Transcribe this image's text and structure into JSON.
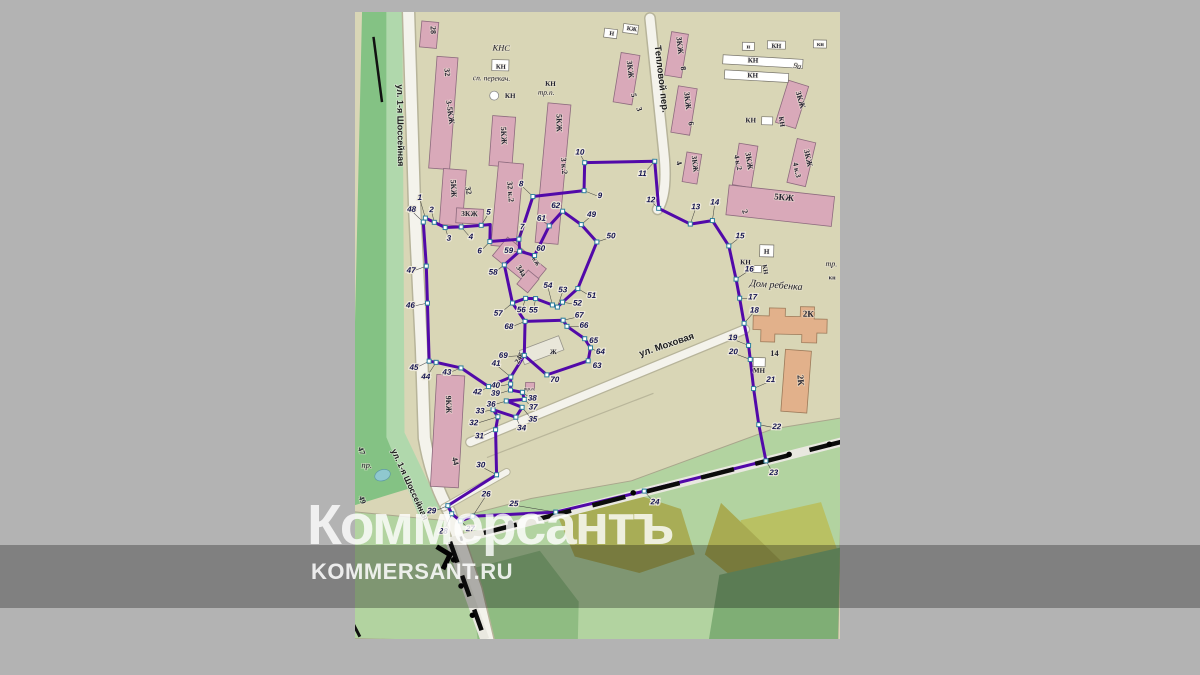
{
  "watermark": {
    "logo": "Коммерсантъ",
    "site": "KOMMERSANT.RU"
  },
  "map": {
    "streets": [
      {
        "name": "ул. 1-я Шоссейная",
        "x": 38,
        "y": 118,
        "r": 88,
        "s": 9
      },
      {
        "name": "ул. 1-я Шоссейная",
        "x": 56,
        "y": 478,
        "r": 64,
        "s": 8.5
      },
      {
        "name": "Тепловой пер.",
        "x": 298,
        "y": 66,
        "r": 82,
        "s": 9.5
      },
      {
        "name": "ул. Моховая",
        "x": 313,
        "y": 334,
        "r": -20,
        "s": 9.5
      }
    ],
    "labels": [
      {
        "t": "28",
        "x": 69,
        "y": 22,
        "r": 86,
        "s": 8
      },
      {
        "t": "32",
        "x": 84,
        "y": 64,
        "r": 84,
        "s": 8
      },
      {
        "t": "3-5КЖ",
        "x": 88,
        "y": 104,
        "r": 80,
        "s": 8
      },
      {
        "t": "5КЖ",
        "x": 93,
        "y": 180,
        "r": 86,
        "s": 8
      },
      {
        "t": "32",
        "x": 108,
        "y": 182,
        "r": 78,
        "s": 8
      },
      {
        "t": "3КЖ",
        "x": 112,
        "y": 207,
        "r": 0,
        "s": 7.5
      },
      {
        "t": "5КЖ",
        "x": 142,
        "y": 126,
        "r": 86,
        "s": 8
      },
      {
        "t": "32 к.2",
        "x": 150,
        "y": 182,
        "r": 84,
        "s": 8
      },
      {
        "t": "5КЖ",
        "x": 197,
        "y": 112,
        "r": 88,
        "s": 8
      },
      {
        "t": "3 к.2",
        "x": 203,
        "y": 155,
        "r": 84,
        "s": 8
      },
      {
        "t": "3КЖ",
        "x": 267,
        "y": 57,
        "r": 82,
        "s": 8
      },
      {
        "t": "5",
        "x": 271,
        "y": 83,
        "r": 78,
        "s": 8
      },
      {
        "t": "3",
        "x": 277,
        "y": 97,
        "r": 70,
        "s": 8
      },
      {
        "t": "3КЖ",
        "x": 316,
        "y": 32,
        "r": 82,
        "s": 8
      },
      {
        "t": "8",
        "x": 320,
        "y": 55,
        "r": 78,
        "s": 8
      },
      {
        "t": "3КЖ",
        "x": 325,
        "y": 87,
        "r": 82,
        "s": 8
      },
      {
        "t": "6",
        "x": 329,
        "y": 110,
        "r": 78,
        "s": 8
      },
      {
        "t": "3КЖ",
        "x": 334,
        "y": 150,
        "r": 82,
        "s": 7.5
      },
      {
        "t": "4",
        "x": 318,
        "y": 150,
        "r": 70,
        "s": 8
      },
      {
        "t": "3КЖ",
        "x": 438,
        "y": 84,
        "r": 72,
        "s": 8
      },
      {
        "t": "3КЖ",
        "x": 388,
        "y": 146,
        "r": 80,
        "s": 8
      },
      {
        "t": "4 к.2",
        "x": 377,
        "y": 148,
        "r": 76,
        "s": 7.5
      },
      {
        "t": "3КЖ",
        "x": 447,
        "y": 142,
        "r": 76,
        "s": 8
      },
      {
        "t": "4 к.3",
        "x": 436,
        "y": 154,
        "r": 76,
        "s": 7.5
      },
      {
        "t": "5КЖ",
        "x": 426,
        "y": 184,
        "r": 4,
        "s": 9
      },
      {
        "t": "2",
        "x": 385,
        "y": 197,
        "r": 72,
        "s": 8
      },
      {
        "t": "9а",
        "x": 436,
        "y": 52,
        "r": 10,
        "s": 8,
        "c": "i"
      },
      {
        "t": "Н",
        "x": 250,
        "y": 23,
        "r": 6,
        "s": 6
      },
      {
        "t": "КЖ",
        "x": 270,
        "y": 18,
        "r": 6,
        "s": 6
      },
      {
        "t": "н",
        "x": 387,
        "y": 33,
        "r": 0,
        "s": 6
      },
      {
        "t": "КН",
        "x": 415,
        "y": 32,
        "r": 0,
        "s": 6.5
      },
      {
        "t": "кн",
        "x": 459,
        "y": 29,
        "r": 0,
        "s": 6
      },
      {
        "t": "КН",
        "x": 392,
        "y": 47,
        "r": 0,
        "s": 7
      },
      {
        "t": "КН",
        "x": 392,
        "y": 62,
        "r": 0,
        "s": 7
      },
      {
        "t": "КН",
        "x": 391,
        "y": 107,
        "r": 0,
        "s": 7
      },
      {
        "t": "КН",
        "x": 420,
        "y": 106,
        "r": 80,
        "s": 7
      },
      {
        "t": "Н",
        "x": 410,
        "y": 238,
        "r": 0,
        "s": 7
      },
      {
        "t": "КН",
        "x": 389,
        "y": 249,
        "r": 0,
        "s": 7
      },
      {
        "t": "КН",
        "x": 407,
        "y": 254,
        "r": 80,
        "s": 6.5
      },
      {
        "t": "Дом ребенка",
        "x": 420,
        "y": 272,
        "r": 3,
        "s": 10,
        "c": "i"
      },
      {
        "t": "тр.",
        "x": 475,
        "y": 249,
        "r": 0,
        "s": 8,
        "c": "i"
      },
      {
        "t": "кн",
        "x": 476,
        "y": 262,
        "r": 0,
        "s": 6
      },
      {
        "t": "2К",
        "x": 453,
        "y": 300,
        "r": 0,
        "s": 9
      },
      {
        "t": "14",
        "x": 420,
        "y": 340,
        "r": 0,
        "s": 8.5
      },
      {
        "t": "2К",
        "x": 444,
        "y": 364,
        "r": 84,
        "s": 9
      },
      {
        "t": "МН",
        "x": 405,
        "y": 357,
        "r": 0,
        "s": 7
      },
      {
        "t": "9КЖ",
        "x": 93,
        "y": 396,
        "r": 87,
        "s": 8
      },
      {
        "t": "44",
        "x": 101,
        "y": 453,
        "r": 74,
        "s": 8
      },
      {
        "t": "34а",
        "x": 163,
        "y": 262,
        "r": 55,
        "s": 8
      },
      {
        "t": "КЖ",
        "x": 178,
        "y": 252,
        "r": 55,
        "s": 5.5
      },
      {
        "t": "24б",
        "x": 167,
        "y": 349,
        "r": -62,
        "s": 7.5
      },
      {
        "t": "Ж",
        "x": 199,
        "y": 343,
        "r": 0,
        "s": 7
      },
      {
        "t": "КНС",
        "x": 140,
        "y": 41,
        "r": 0,
        "s": 8.5,
        "c": "i"
      },
      {
        "t": "КН",
        "x": 140,
        "y": 59,
        "r": 0,
        "s": 6.5
      },
      {
        "t": "сп. перекач.",
        "x": 131,
        "y": 71,
        "r": 0,
        "s": 7.5,
        "c": "i"
      },
      {
        "t": "КН",
        "x": 150,
        "y": 88,
        "r": 0,
        "s": 7
      },
      {
        "t": "КН",
        "x": 190,
        "y": 75,
        "r": 0,
        "s": 7
      },
      {
        "t": "тр.п.",
        "x": 186,
        "y": 84,
        "r": 0,
        "s": 7.5,
        "c": "i"
      },
      {
        "t": "тр.п.",
        "x": 176,
        "y": 380,
        "r": 0,
        "s": 5,
        "c": "i"
      },
      {
        "t": "47",
        "x": 7,
        "y": 445,
        "r": 70,
        "s": 8
      },
      {
        "t": "пр.",
        "x": 15,
        "y": 461,
        "r": 0,
        "s": 8.5,
        "c": "i"
      },
      {
        "t": "49",
        "x": 9,
        "y": 494,
        "r": 70,
        "s": 8
      }
    ],
    "boxes": [
      {
        "x": 131,
        "y": 50,
        "w": 17,
        "h": 11,
        "r": 0
      },
      {
        "x": 243,
        "y": 16,
        "w": 13,
        "h": 9,
        "r": 6
      },
      {
        "x": 262,
        "y": 11,
        "w": 15,
        "h": 9,
        "r": 6
      },
      {
        "x": 381,
        "y": 27,
        "w": 12,
        "h": 8,
        "r": 0
      },
      {
        "x": 406,
        "y": 25,
        "w": 18,
        "h": 8,
        "r": 0
      },
      {
        "x": 452,
        "y": 23,
        "w": 13,
        "h": 8,
        "r": 0
      },
      {
        "x": 362,
        "y": 40,
        "w": 80,
        "h": 9,
        "r": 2
      },
      {
        "x": 364,
        "y": 55,
        "w": 64,
        "h": 9,
        "r": 2
      },
      {
        "x": 402,
        "y": 101,
        "w": 11,
        "h": 8,
        "r": 0
      },
      {
        "x": 403,
        "y": 229,
        "w": 14,
        "h": 12,
        "r": 0
      },
      {
        "x": 399,
        "y": 342,
        "w": 12,
        "h": 9,
        "r": 0
      },
      {
        "x": 396,
        "y": 250,
        "w": 9,
        "h": 7,
        "r": 0
      }
    ],
    "points": [
      {
        "n": 1,
        "x": 68,
        "y": 210,
        "lx": 62,
        "ly": 189
      },
      {
        "n": 2,
        "x": 77,
        "y": 214,
        "lx": 74,
        "ly": 201
      },
      {
        "n": 3,
        "x": 88,
        "y": 219,
        "lx": 92,
        "ly": 229
      },
      {
        "n": 4,
        "x": 104,
        "y": 218,
        "lx": 114,
        "ly": 227
      },
      {
        "n": 5,
        "x": 124,
        "y": 216,
        "lx": 131,
        "ly": 202
      },
      {
        "n": 6,
        "x": 133,
        "y": 232,
        "lx": 123,
        "ly": 241
      },
      {
        "n": 7,
        "x": 162,
        "y": 229,
        "lx": 165,
        "ly": 216
      },
      {
        "n": 8,
        "x": 175,
        "y": 186,
        "lx": 163,
        "ly": 173
      },
      {
        "n": 9,
        "x": 226,
        "y": 179,
        "lx": 242,
        "ly": 183
      },
      {
        "n": 10,
        "x": 226,
        "y": 151,
        "lx": 221,
        "ly": 140
      },
      {
        "n": 11,
        "x": 296,
        "y": 148,
        "lx": 284,
        "ly": 160
      },
      {
        "n": 12,
        "x": 301,
        "y": 195,
        "lx": 293,
        "ly": 186
      },
      {
        "n": 13,
        "x": 333,
        "y": 210,
        "lx": 338,
        "ly": 192
      },
      {
        "n": 14,
        "x": 355,
        "y": 206,
        "lx": 357,
        "ly": 187
      },
      {
        "n": 15,
        "x": 372,
        "y": 231,
        "lx": 383,
        "ly": 220
      },
      {
        "n": 16,
        "x": 380,
        "y": 264,
        "lx": 393,
        "ly": 253
      },
      {
        "n": 17,
        "x": 384,
        "y": 283,
        "lx": 397,
        "ly": 281
      },
      {
        "n": 18,
        "x": 389,
        "y": 308,
        "lx": 399,
        "ly": 294
      },
      {
        "n": 19,
        "x": 394,
        "y": 330,
        "lx": 378,
        "ly": 322
      },
      {
        "n": 20,
        "x": 396,
        "y": 344,
        "lx": 379,
        "ly": 336
      },
      {
        "n": 21,
        "x": 400,
        "y": 373,
        "lx": 417,
        "ly": 363
      },
      {
        "n": 22,
        "x": 406,
        "y": 409,
        "lx": 424,
        "ly": 410
      },
      {
        "n": 23,
        "x": 414,
        "y": 445,
        "lx": 422,
        "ly": 456
      },
      {
        "n": 24,
        "x": 293,
        "y": 478,
        "lx": 304,
        "ly": 488
      },
      {
        "n": 25,
        "x": 205,
        "y": 501,
        "lx": 163,
        "ly": 493
      },
      {
        "n": 26,
        "x": 122,
        "y": 507,
        "lx": 135,
        "ly": 484
      },
      {
        "n": 27,
        "x": 110,
        "y": 512,
        "lx": 120,
        "ly": 519
      },
      {
        "n": 28,
        "x": 101,
        "y": 505,
        "lx": 93,
        "ly": 522
      },
      {
        "n": 29,
        "x": 97,
        "y": 497,
        "lx": 81,
        "ly": 502
      },
      {
        "n": 30,
        "x": 145,
        "y": 465,
        "lx": 129,
        "ly": 455
      },
      {
        "n": 31,
        "x": 143,
        "y": 420,
        "lx": 127,
        "ly": 426
      },
      {
        "n": 32,
        "x": 145,
        "y": 407,
        "lx": 121,
        "ly": 413
      },
      {
        "n": 33,
        "x": 140,
        "y": 400,
        "lx": 127,
        "ly": 401
      },
      {
        "n": 34,
        "x": 163,
        "y": 407,
        "lx": 169,
        "ly": 417
      },
      {
        "n": 35,
        "x": 169,
        "y": 397,
        "lx": 180,
        "ly": 408
      },
      {
        "n": 36,
        "x": 153,
        "y": 391,
        "lx": 138,
        "ly": 394
      },
      {
        "n": 37,
        "x": 171,
        "y": 389,
        "lx": 180,
        "ly": 396
      },
      {
        "n": 38,
        "x": 169,
        "y": 382,
        "lx": 179,
        "ly": 387
      },
      {
        "n": 39,
        "x": 157,
        "y": 380,
        "lx": 142,
        "ly": 383
      },
      {
        "n": 40,
        "x": 157,
        "y": 374,
        "lx": 142,
        "ly": 375
      },
      {
        "n": 41,
        "x": 157,
        "y": 367,
        "lx": 142,
        "ly": 353
      },
      {
        "n": 42,
        "x": 135,
        "y": 377,
        "lx": 124,
        "ly": 382
      },
      {
        "n": 43,
        "x": 107,
        "y": 359,
        "lx": 93,
        "ly": 363
      },
      {
        "n": 44,
        "x": 82,
        "y": 354,
        "lx": 72,
        "ly": 368
      },
      {
        "n": 45,
        "x": 75,
        "y": 353,
        "lx": 60,
        "ly": 359
      },
      {
        "n": 46,
        "x": 72,
        "y": 295,
        "lx": 55,
        "ly": 297
      },
      {
        "n": 47,
        "x": 70,
        "y": 258,
        "lx": 55,
        "ly": 262
      },
      {
        "n": 48,
        "x": 66,
        "y": 214,
        "lx": 54,
        "ly": 201
      },
      {
        "n": 49,
        "x": 224,
        "y": 213,
        "lx": 234,
        "ly": 202
      },
      {
        "n": 50,
        "x": 240,
        "y": 230,
        "lx": 254,
        "ly": 223
      },
      {
        "n": 51,
        "x": 222,
        "y": 277,
        "lx": 236,
        "ly": 283
      },
      {
        "n": 52,
        "x": 207,
        "y": 291,
        "lx": 222,
        "ly": 291
      },
      {
        "n": 53,
        "x": 202,
        "y": 296,
        "lx": 207,
        "ly": 278
      },
      {
        "n": 54,
        "x": 197,
        "y": 294,
        "lx": 192,
        "ly": 274
      },
      {
        "n": 55,
        "x": 180,
        "y": 288,
        "lx": 178,
        "ly": 299
      },
      {
        "n": 56,
        "x": 170,
        "y": 288,
        "lx": 166,
        "ly": 299
      },
      {
        "n": 57,
        "x": 157,
        "y": 293,
        "lx": 143,
        "ly": 303
      },
      {
        "n": 58,
        "x": 148,
        "y": 255,
        "lx": 137,
        "ly": 262
      },
      {
        "n": 59,
        "x": 163,
        "y": 241,
        "lx": 152,
        "ly": 240
      },
      {
        "n": 60,
        "x": 178,
        "y": 245,
        "lx": 184,
        "ly": 237
      },
      {
        "n": 61,
        "x": 192,
        "y": 215,
        "lx": 184,
        "ly": 207
      },
      {
        "n": 62,
        "x": 205,
        "y": 200,
        "lx": 198,
        "ly": 194
      },
      {
        "n": 63,
        "x": 234,
        "y": 349,
        "lx": 243,
        "ly": 353
      },
      {
        "n": 64,
        "x": 236,
        "y": 336,
        "lx": 246,
        "ly": 339
      },
      {
        "n": 65,
        "x": 230,
        "y": 327,
        "lx": 239,
        "ly": 328
      },
      {
        "n": 66,
        "x": 212,
        "y": 315,
        "lx": 229,
        "ly": 313
      },
      {
        "n": 67,
        "x": 208,
        "y": 309,
        "lx": 224,
        "ly": 303
      },
      {
        "n": 68,
        "x": 170,
        "y": 311,
        "lx": 154,
        "ly": 316
      },
      {
        "n": 69,
        "x": 170,
        "y": 345,
        "lx": 149,
        "ly": 345
      },
      {
        "n": 70,
        "x": 193,
        "y": 364,
        "lx": 201,
        "ly": 368
      }
    ]
  }
}
